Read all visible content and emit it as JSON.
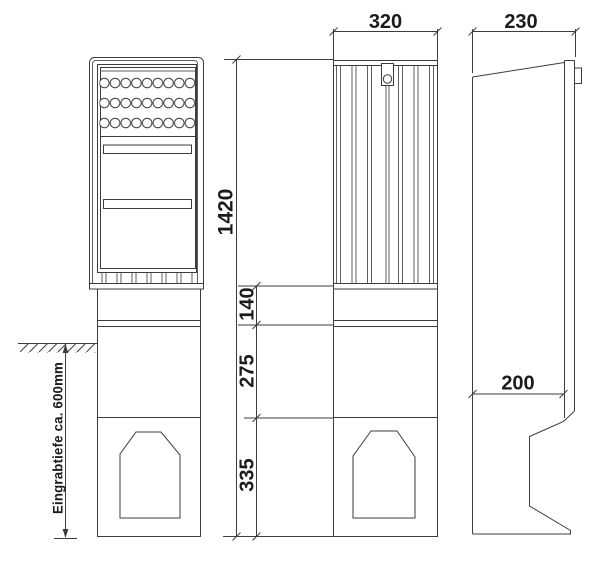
{
  "drawing": {
    "kind": "technical-dimension-drawing",
    "dimensions": {
      "front_width": "320",
      "side_depth": "230",
      "total_height": "1420",
      "section_top": "140",
      "section_middle": "275",
      "section_base": "335",
      "base_depth": "200",
      "burial_depth_note": "Eingrabtiefe ca. 600mm"
    },
    "colors": {
      "line": "#3c3c3c",
      "line_light": "#606060",
      "text": "#1b1b1b",
      "background": "#ffffff"
    }
  }
}
